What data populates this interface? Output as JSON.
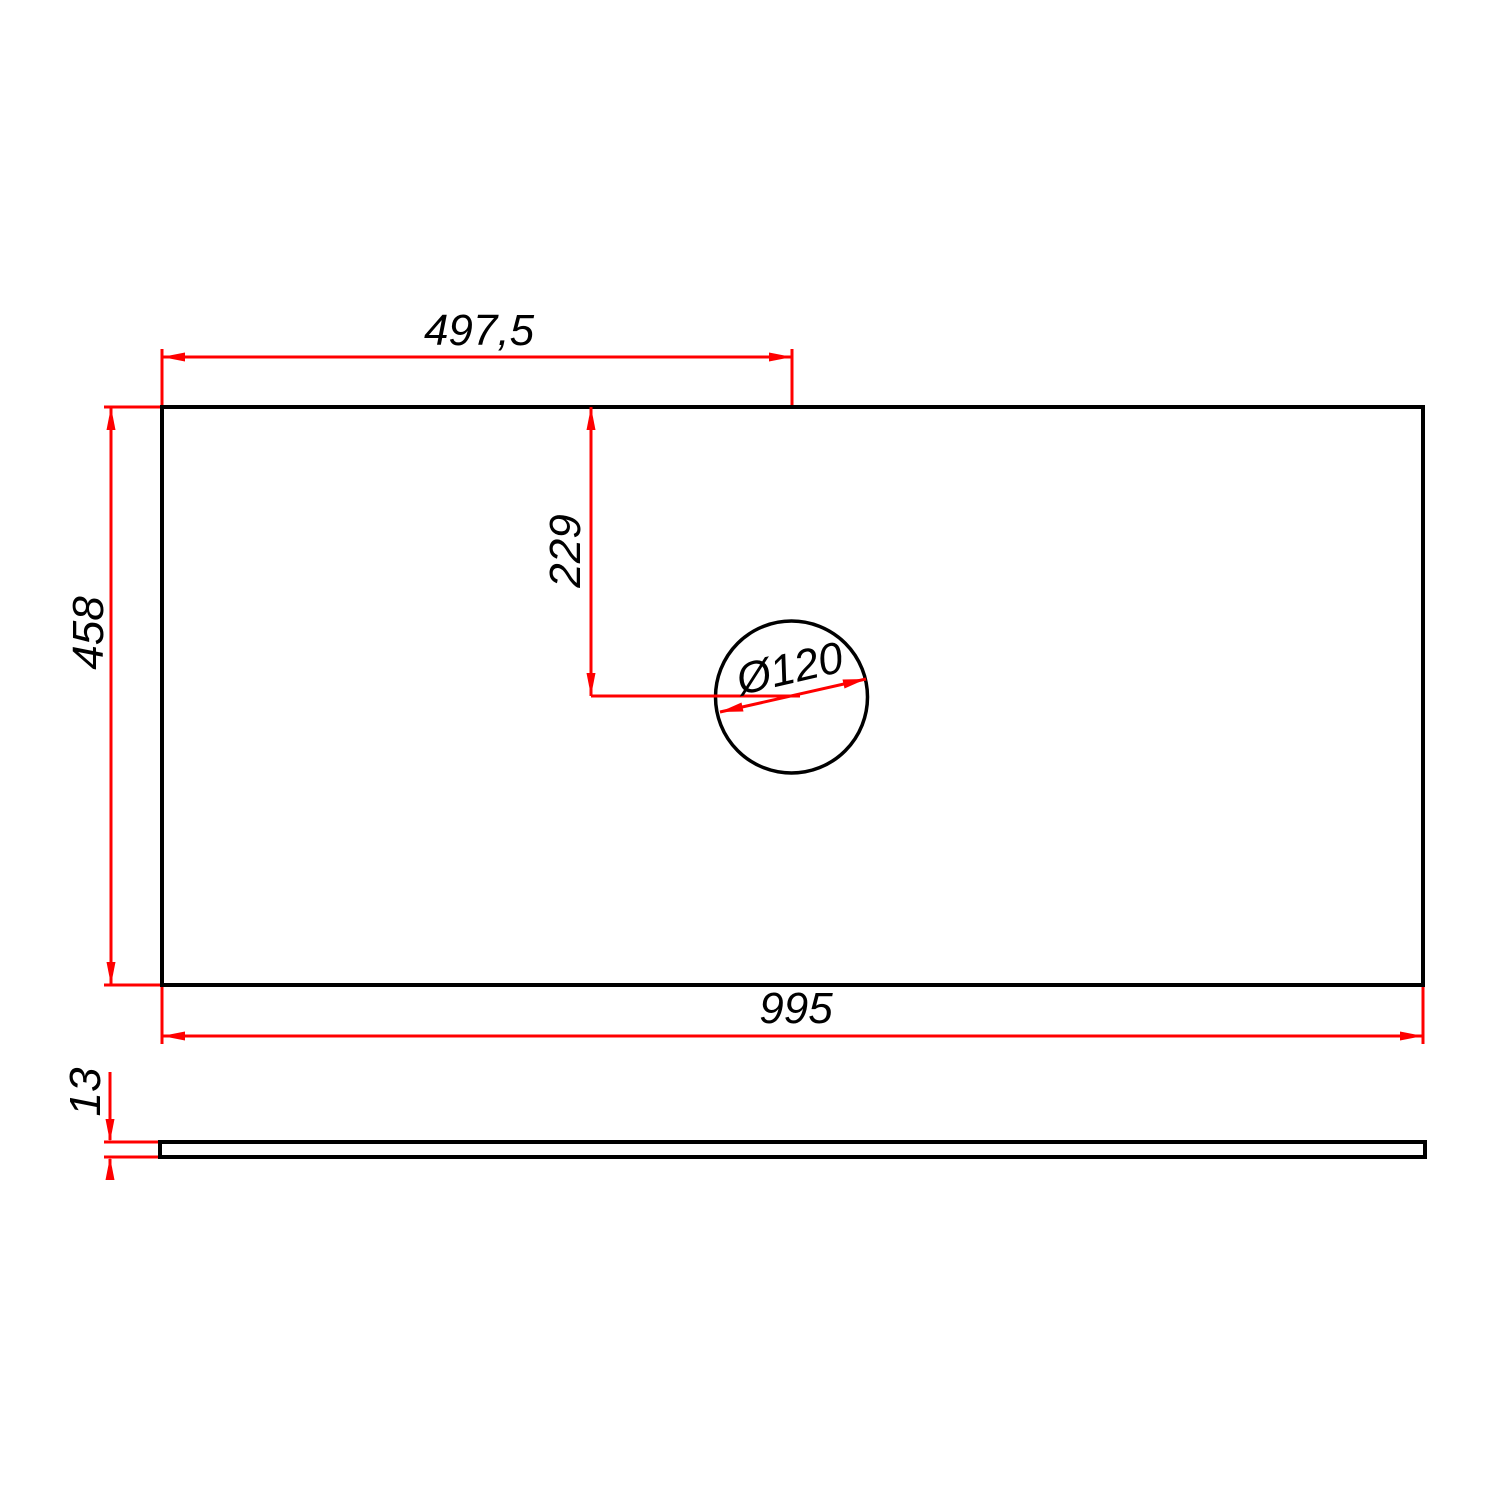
{
  "drawing": {
    "kind": "technical-dimension-drawing",
    "colors": {
      "outline": "#000000",
      "dimension": "#ff0000",
      "background": "#ffffff"
    },
    "views": {
      "top_view": {
        "panel_width_label": "995",
        "panel_depth_label": "458",
        "hole": {
          "diameter_label": "Ø120",
          "offset_from_left_label": "497,5",
          "offset_from_top_label": "229"
        }
      },
      "side_view": {
        "thickness_label": "13"
      }
    }
  }
}
